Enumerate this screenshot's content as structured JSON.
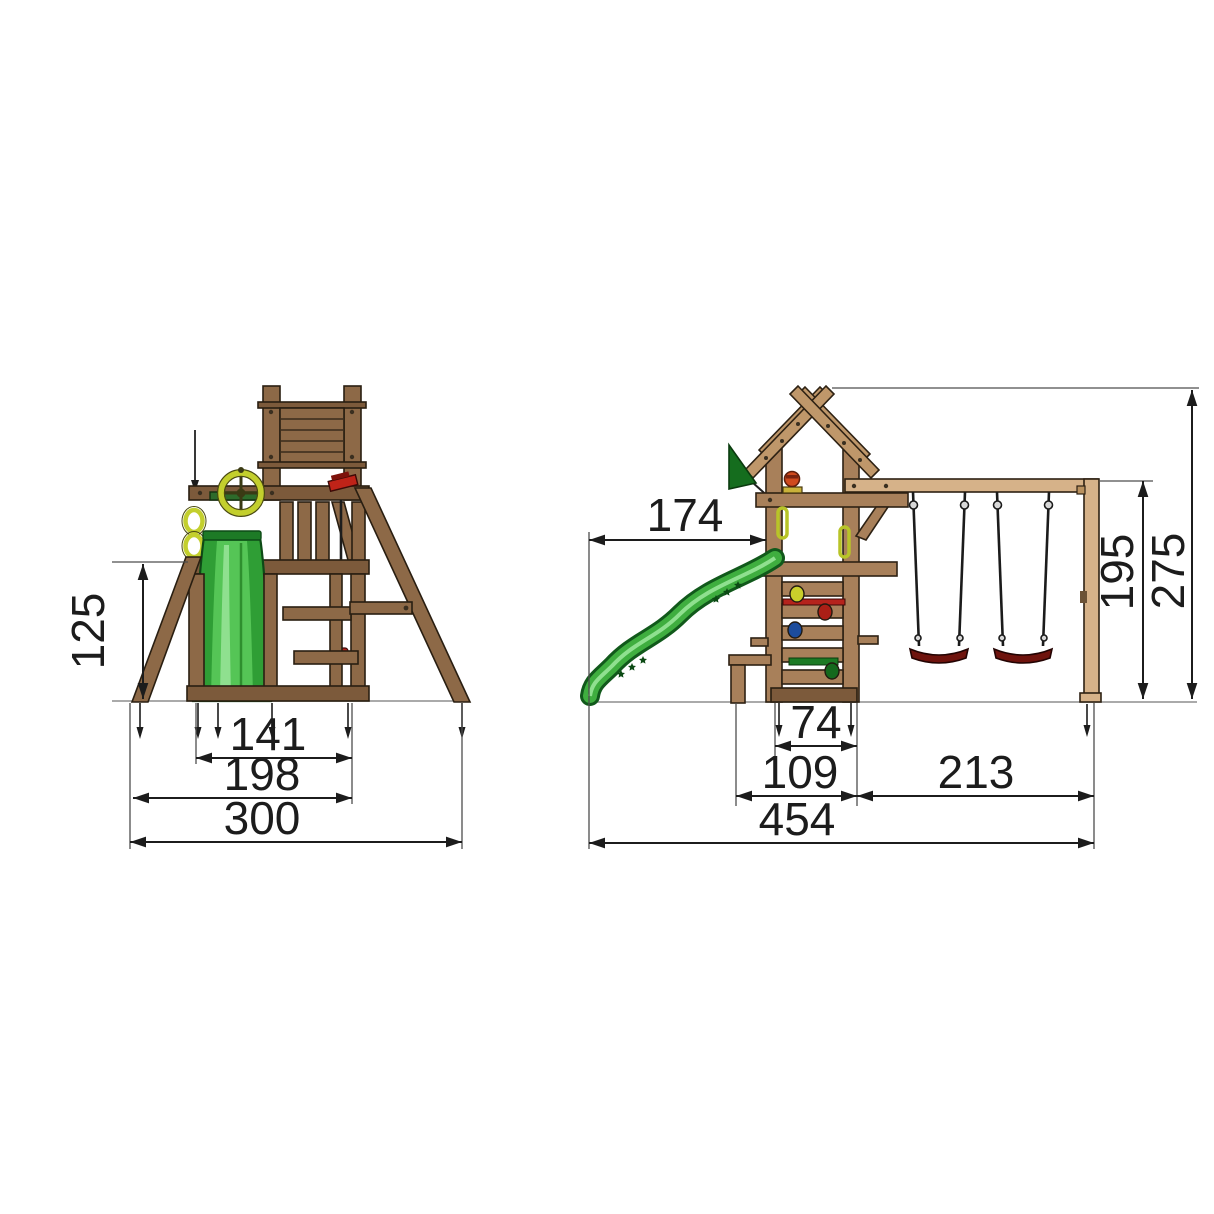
{
  "drawing": {
    "type": "playground-dimension-drawing",
    "views": {
      "front": {
        "dimensions": {
          "platform_height": "125",
          "inner_width": "141",
          "frame_width": "198",
          "total_width": "300"
        }
      },
      "side": {
        "dimensions": {
          "slide_reach": "174",
          "swing_beam_height": "195",
          "total_height": "275",
          "tower_depth": "74",
          "tower_base_depth": "109",
          "swing_bay_depth": "213",
          "total_depth": "454"
        }
      }
    },
    "colors": {
      "wood_front": "#8d6947",
      "wood_side": "#a8805a",
      "wood_pale": "#d6b289",
      "roof_wood": "#bf976a",
      "slide_green": "#3fae3f",
      "slide_green_dark": "#11591b",
      "flag_green": "#156d1e",
      "swing_seat_red": "#6f130d",
      "steering_wheel_yellow": "#c3cf2d",
      "dimension_line": "#1c1c1c"
    }
  }
}
